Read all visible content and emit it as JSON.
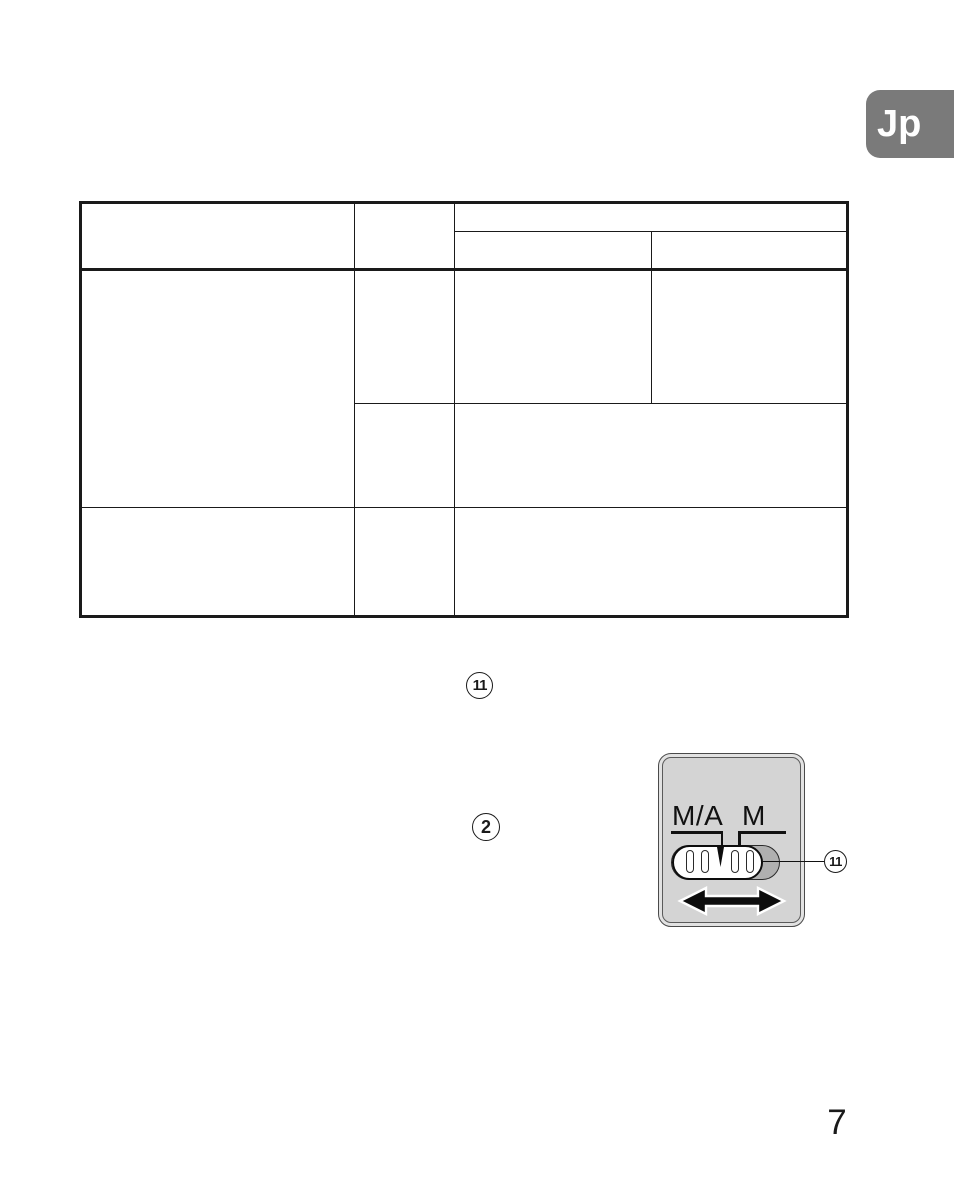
{
  "page": {
    "number": "7"
  },
  "language_tab": {
    "label": "Jp",
    "bg_color": "#7a7a7a",
    "text_color": "#ffffff"
  },
  "inline_refs": {
    "ref_11": "11",
    "ref_2": "2"
  },
  "switch_diagram": {
    "mode_left": "M/A",
    "mode_right": "M",
    "callout_label": "11",
    "body_color": "#d4d4d4",
    "track_color": "#b0b0b0",
    "slider_color": "#ffffff",
    "arrow_icon": "left-right-slide-arrow"
  },
  "colors": {
    "line": "#1a1a1a",
    "background": "#ffffff"
  }
}
